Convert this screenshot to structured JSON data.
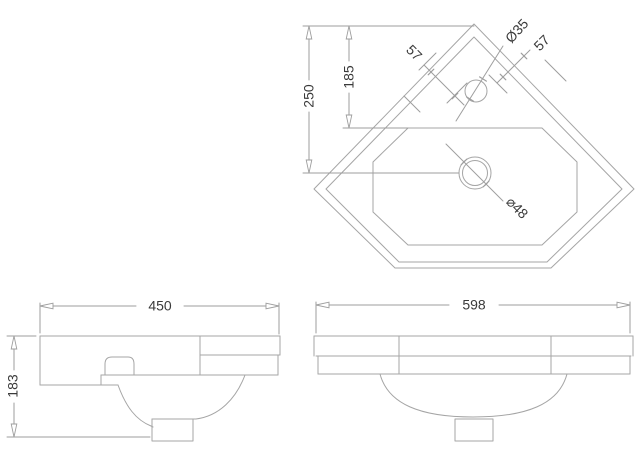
{
  "colors": {
    "background": "#ffffff",
    "drawing_line": "#a5a5a5",
    "dimension_line": "#9e9e9e",
    "dimension_text": "#3a3a3a"
  },
  "views": {
    "plan": {
      "dimensions": {
        "overall_depth": "250",
        "basin_rear_depth": "185",
        "tap_offset_left": "57",
        "tap_offset_right": "57",
        "tap_hole_diameter": "Ø35",
        "waste_hole_diameter": "⌀48"
      }
    },
    "side": {
      "dimensions": {
        "depth": "450",
        "height": "183"
      }
    },
    "front": {
      "dimensions": {
        "width": "598"
      }
    }
  }
}
